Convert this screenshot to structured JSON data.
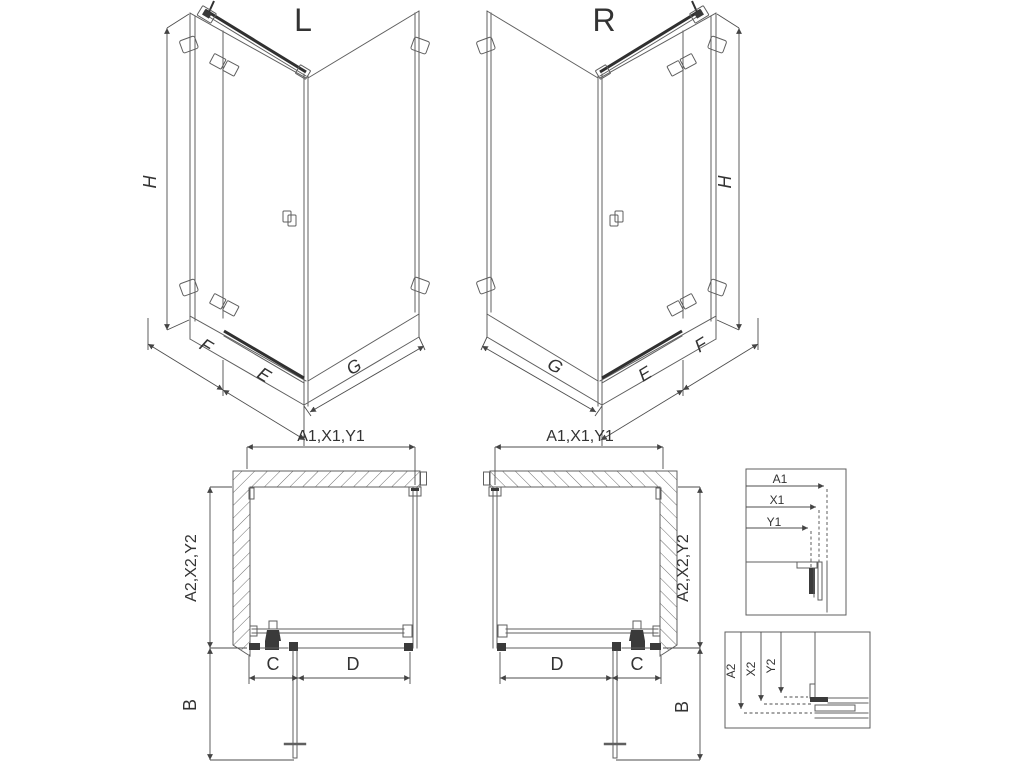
{
  "drawing": {
    "type": "shower-enclosure-technical-drawing",
    "labels": {
      "iso_left_title": "L",
      "iso_right_title": "R",
      "height": "H",
      "fixed_panel_width": "F",
      "door_width": "E",
      "side_panel_width": "G",
      "plan_width_range": "A1,X1,Y1",
      "plan_depth_range": "A2,X2,Y2",
      "door_swing": "B",
      "entry_width": "C",
      "front_fixed_width": "D"
    },
    "detail_width_dims": {
      "a1": "A1",
      "x1": "X1",
      "y1": "Y1"
    },
    "detail_depth_dims": {
      "a2": "A2",
      "x2": "X2",
      "y2": "Y2"
    },
    "colors": {
      "background": "#ffffff",
      "line": "#5f5f5f",
      "dark_line": "#303030",
      "text": "#333333"
    }
  }
}
